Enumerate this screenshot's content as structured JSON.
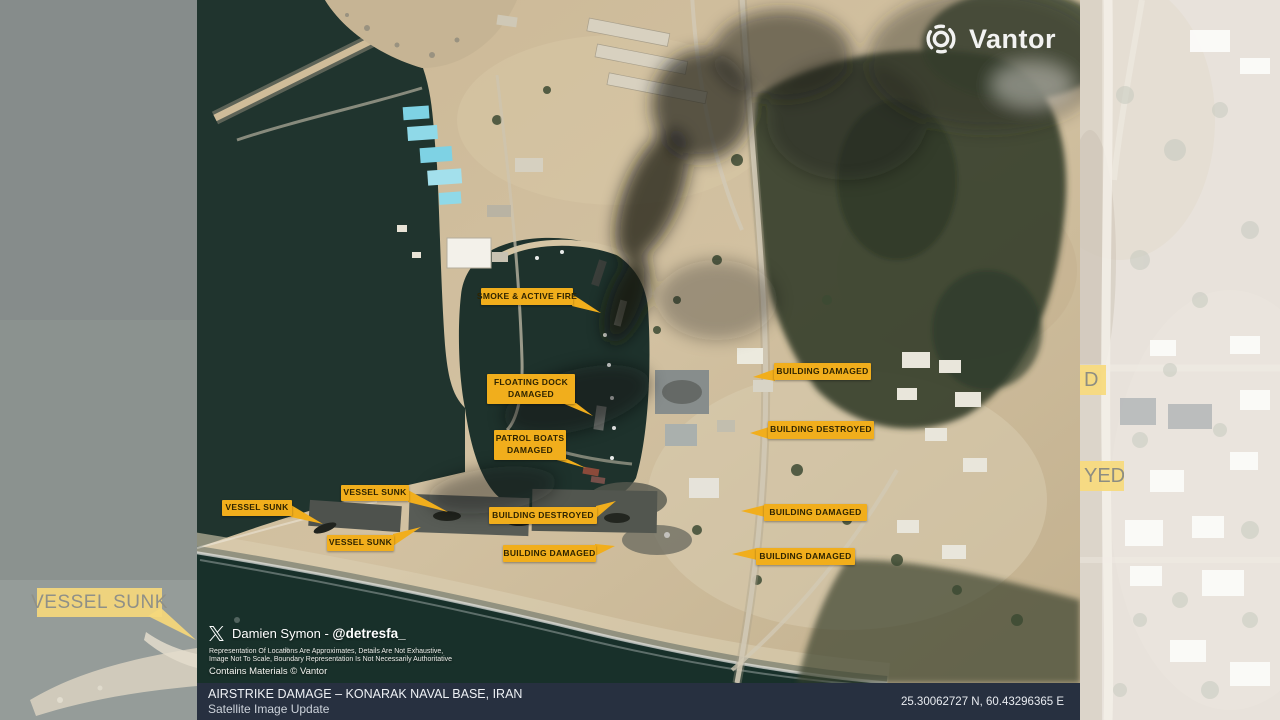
{
  "brand": {
    "name": "Vantor"
  },
  "annotations": [
    {
      "lines": [
        "SMOKE & ACTIVE FIRE"
      ],
      "x": 284,
      "y": 288,
      "w": 92,
      "h": 17,
      "side": "right",
      "tip": [
        404,
        313
      ]
    },
    {
      "lines": [
        "FLOATING DOCK",
        "DAMAGED"
      ],
      "x": 290,
      "y": 374,
      "w": 88,
      "h": 30,
      "side": "bottom",
      "tip": [
        396,
        416
      ]
    },
    {
      "lines": [
        "PATROL BOATS",
        "DAMAGED"
      ],
      "x": 297,
      "y": 430,
      "w": 72,
      "h": 30,
      "side": "bottom",
      "tip": [
        389,
        468
      ]
    },
    {
      "lines": [
        "BUILDING DAMAGED"
      ],
      "x": 577,
      "y": 363,
      "w": 97,
      "h": 17,
      "side": "left",
      "tip": [
        556,
        377
      ]
    },
    {
      "lines": [
        "BUILDING DESTROYED"
      ],
      "x": 571,
      "y": 421,
      "w": 106,
      "h": 18,
      "side": "left",
      "tip": [
        553,
        433
      ]
    },
    {
      "lines": [
        "VESSEL SUNK"
      ],
      "x": 144,
      "y": 485,
      "w": 68,
      "h": 16,
      "side": "right",
      "tip": [
        251,
        512
      ]
    },
    {
      "lines": [
        "VESSEL SUNK"
      ],
      "x": 25,
      "y": 500,
      "w": 70,
      "h": 16,
      "side": "right",
      "tip": [
        126,
        524
      ]
    },
    {
      "lines": [
        "VESSEL SUNK"
      ],
      "x": 130,
      "y": 535,
      "w": 67,
      "h": 16,
      "side": "right",
      "tip": [
        224,
        527
      ]
    },
    {
      "lines": [
        "BUILDING DESTROYED"
      ],
      "x": 292,
      "y": 507,
      "w": 108,
      "h": 17,
      "side": "right",
      "tip": [
        419,
        501
      ]
    },
    {
      "lines": [
        "BUILDING DAMAGED"
      ],
      "x": 306,
      "y": 545,
      "w": 93,
      "h": 17,
      "side": "right",
      "tip": [
        418,
        546
      ]
    },
    {
      "lines": [
        "BUILDING DAMAGED"
      ],
      "x": 567,
      "y": 504,
      "w": 103,
      "h": 17,
      "side": "left",
      "tip": [
        544,
        511
      ]
    },
    {
      "lines": [
        "BUILDING DAMAGED"
      ],
      "x": 559,
      "y": 548,
      "w": 99,
      "h": 17,
      "side": "left",
      "tip": [
        535,
        554
      ]
    }
  ],
  "background_labels": {
    "left": {
      "text": "VESSEL SUNK"
    },
    "right_top_partial": {
      "text": "D"
    },
    "right_bottom_partial": {
      "text": "YED"
    }
  },
  "attribution": {
    "author_prefix": "Damien Symon - ",
    "author_handle": "@detresfa_",
    "disclaimer_line1": "Representation Of Locations Are Approximates, Details Are Not Exhaustive,",
    "disclaimer_line2": "Image Not To Scale, Boundary Representation Is Not Necessarily Authoritative",
    "materials": "Contains Materials © Vantor"
  },
  "footer": {
    "title": "AIRSTRIKE DAMAGE – KONARAK NAVAL BASE, IRAN",
    "subtitle": "Satellite Image Update",
    "coordinates": "25.30062727 N, 60.43296365 E"
  },
  "colors": {
    "label_bg": "#F1AE1C",
    "label_text": "#2F2400",
    "faded_label_bg": "#F5D87C",
    "faded_label_text": "#8F9088",
    "footer_bg": "#273040",
    "water": "#20342E",
    "terrain": "#CBB795",
    "vegetation": "#36412D"
  }
}
